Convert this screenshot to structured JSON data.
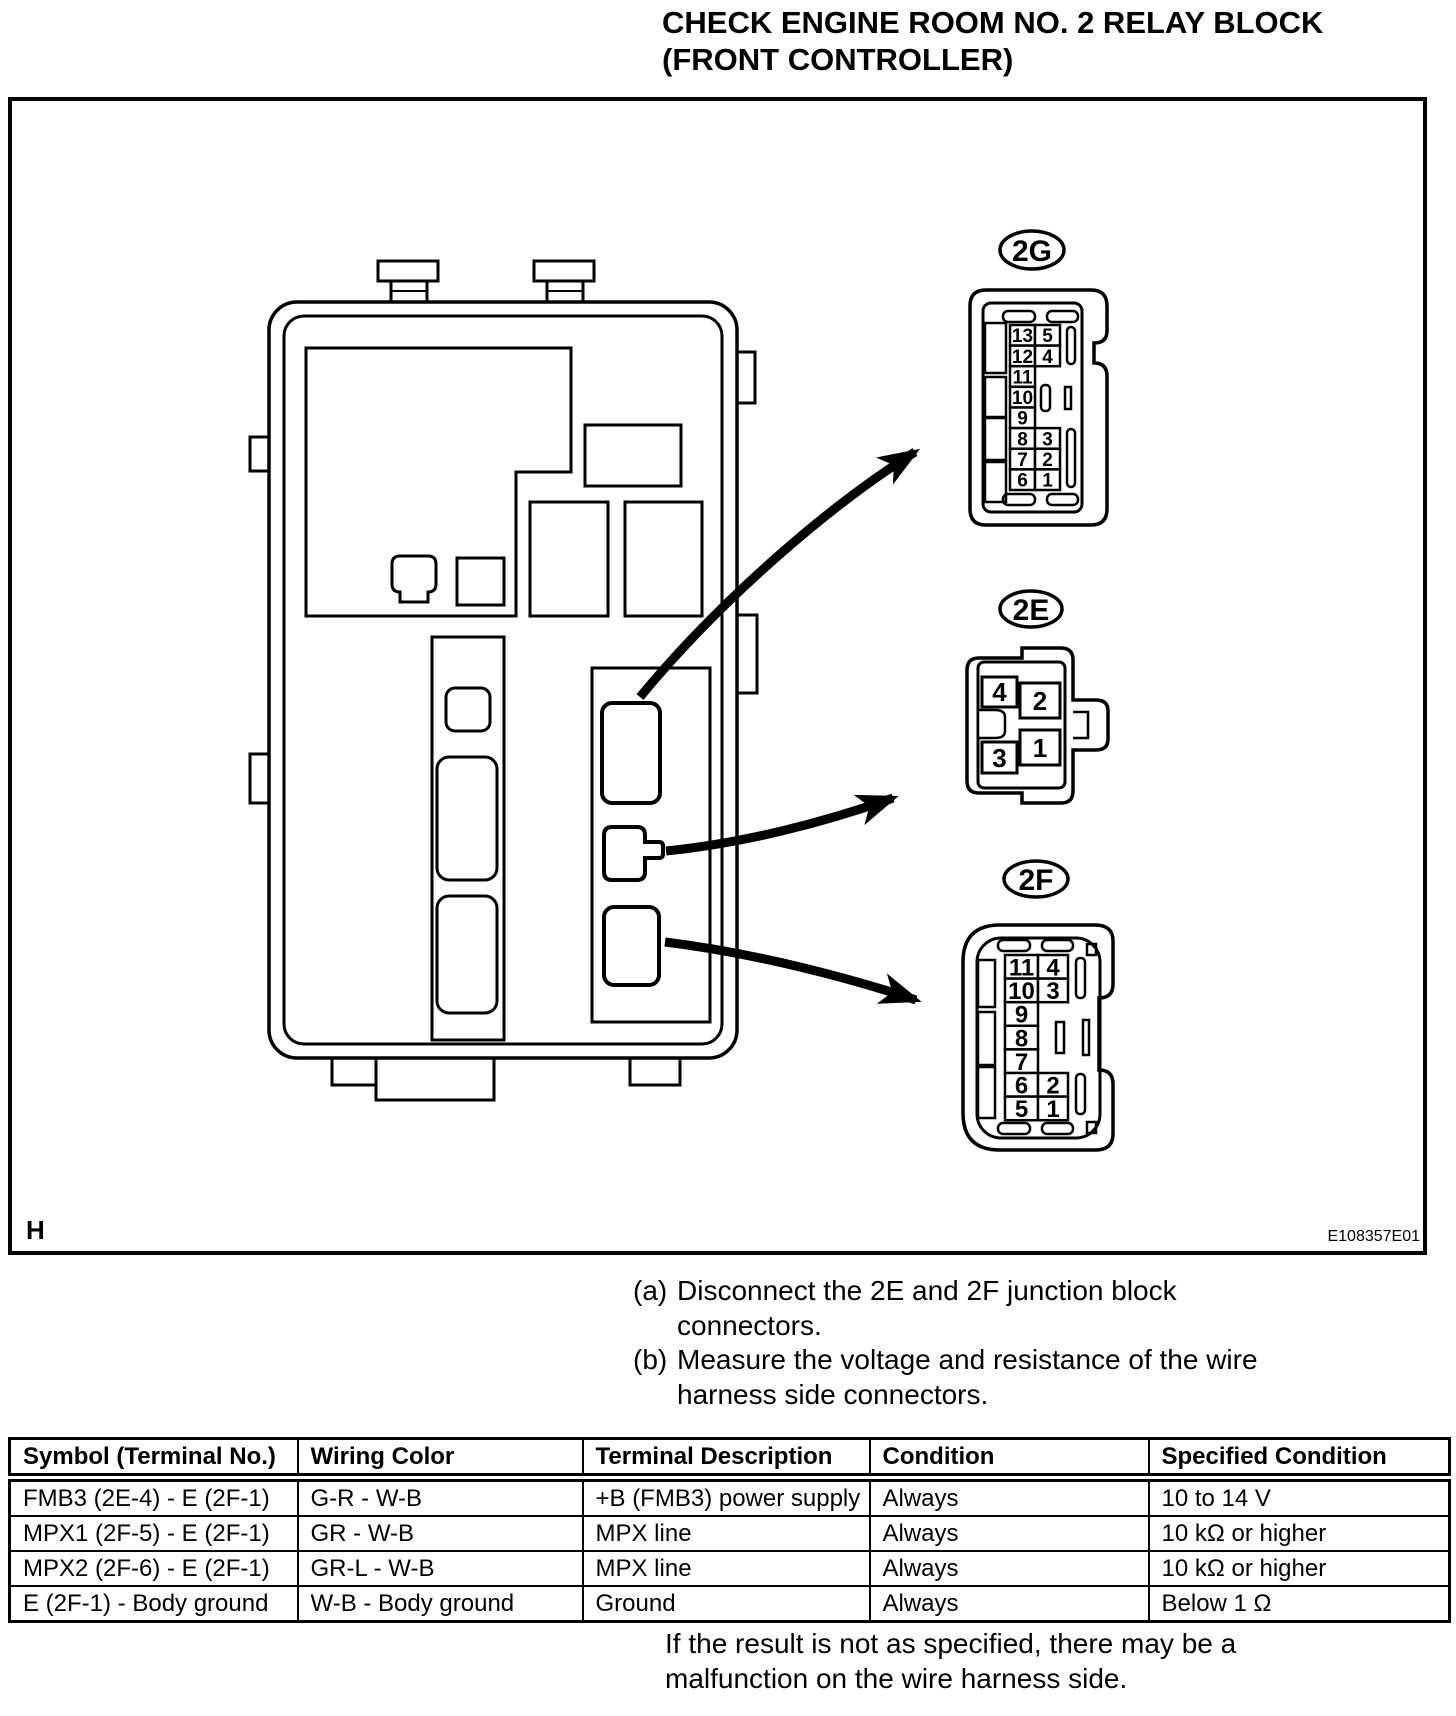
{
  "title": {
    "lines": [
      "CHECK ENGINE ROOM NO. 2 RELAY BLOCK",
      "(FRONT CONTROLLER)"
    ]
  },
  "figure": {
    "corner_label": "H",
    "code": "E108357E01",
    "connectors": {
      "c2g": {
        "label": "2G",
        "left_pins": [
          "13",
          "12",
          "11",
          "10",
          "9",
          "8",
          "7",
          "6"
        ],
        "right_pins": [
          "5",
          "4",
          "3",
          "2",
          "1"
        ]
      },
      "c2e": {
        "label": "2E",
        "pins": [
          "4",
          "2",
          "3",
          "1"
        ]
      },
      "c2f": {
        "label": "2F",
        "left_pins": [
          "11",
          "10",
          "9",
          "8",
          "7",
          "6",
          "5"
        ],
        "right_pins": [
          "4",
          "3",
          "2",
          "1"
        ]
      }
    }
  },
  "steps": [
    {
      "marker": "(a)",
      "lines": [
        "Disconnect the 2E and 2F junction block",
        "connectors."
      ]
    },
    {
      "marker": "(b)",
      "lines": [
        "Measure the voltage and resistance of the wire",
        "harness side connectors."
      ]
    }
  ],
  "table": {
    "headers": [
      "Symbol (Terminal No.)",
      "Wiring Color",
      "Terminal Description",
      "Condition",
      "Specified Condition"
    ],
    "rows": [
      [
        "FMB3 (2E-4) - E (2F-1)",
        "G-R - W-B",
        "+B (FMB3) power supply",
        "Always",
        "10 to 14 V"
      ],
      [
        "MPX1 (2F-5) - E (2F-1)",
        "GR - W-B",
        "MPX line",
        "Always",
        "10 kΩ or higher"
      ],
      [
        "MPX2 (2F-6) - E (2F-1)",
        "GR-L - W-B",
        "MPX line",
        "Always",
        "10 kΩ or higher"
      ],
      [
        "E (2F-1) - Body ground",
        "W-B - Body ground",
        "Ground",
        "Always",
        "Below 1 Ω"
      ]
    ]
  },
  "note_lines": [
    "If the result is not as specified, there may be a",
    "malfunction on the wire harness side."
  ],
  "colors": {
    "ink": "#000000",
    "paper": "#ffffff"
  }
}
